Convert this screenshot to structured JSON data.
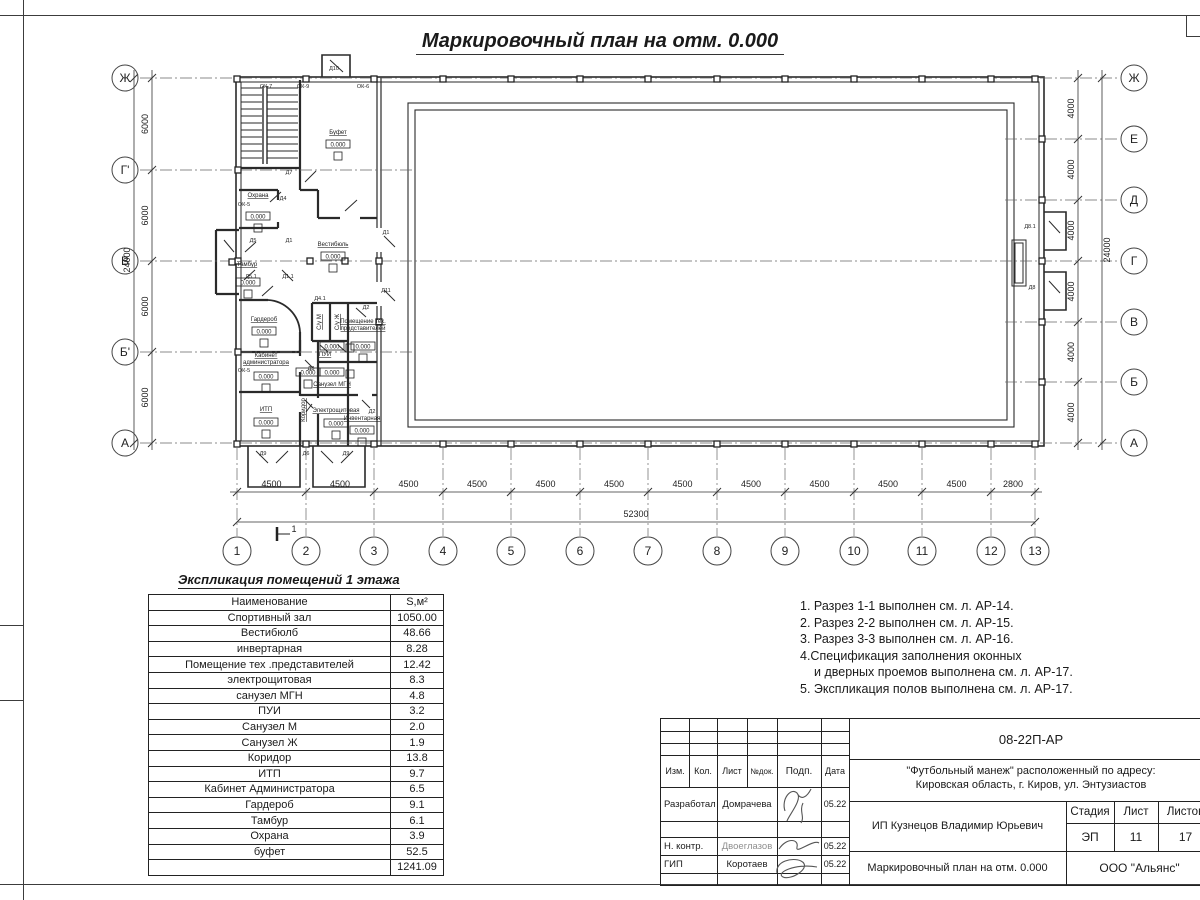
{
  "sheet": {
    "title": "Маркировочный план на отм. 0.000"
  },
  "elevation_mark": "0.000",
  "section_mark": "1",
  "axes": {
    "left": [
      "Ж",
      "Г'",
      "В",
      "Б'",
      "А"
    ],
    "right": [
      "Ж",
      "Е",
      "Д",
      "Г",
      "В",
      "Б",
      "А"
    ],
    "bottom": [
      "1",
      "2",
      "3",
      "4",
      "5",
      "6",
      "7",
      "8",
      "9",
      "10",
      "11",
      "12",
      "13"
    ]
  },
  "dimensions": {
    "left_segments": [
      "6000",
      "6000",
      "6000",
      "6000"
    ],
    "left_total": "24000",
    "right_segments": [
      "4000",
      "4000",
      "4000",
      "4000",
      "4000",
      "4000"
    ],
    "right_total": "24000",
    "bottom_segments": [
      "4500",
      "4500",
      "4500",
      "4500",
      "4500",
      "4500",
      "4500",
      "4500",
      "4500",
      "4500",
      "4500",
      "2800"
    ],
    "bottom_total": "52300"
  },
  "rooms": [
    {
      "name": "Буфет"
    },
    {
      "name": "Охрана"
    },
    {
      "name": "Тамбур"
    },
    {
      "name": "Вестибюль"
    },
    {
      "name": "Гардероб"
    },
    {
      "name": "Кабинет администратора"
    },
    {
      "name": "ИТП"
    },
    {
      "name": "Коридор"
    },
    {
      "name": "С/у М"
    },
    {
      "name": "С/у Ж"
    },
    {
      "name": "ПУИ"
    },
    {
      "name": "Санузел МГН"
    },
    {
      "name": "Помещение тех. представителей"
    },
    {
      "name": "Инвентарная"
    },
    {
      "name": "Электрощитовая"
    }
  ],
  "tags": [
    "ОК-7",
    "ОК-9",
    "Д10",
    "ОК-6",
    "ОК-5",
    "Д7",
    "Д4",
    "Д5",
    "Д1",
    "Д5.1",
    "Д1.1",
    "Д1",
    "Д11",
    "Д4.1",
    "Д2",
    "Д3",
    "ОК-5",
    "Д9",
    "Д6",
    "Д9",
    "Д2",
    "Д8.1",
    "Д8"
  ],
  "room_table": {
    "title": "Экспликация помещений 1 этажа",
    "headers": [
      "Наименование",
      "S,м²"
    ],
    "rows": [
      [
        "Спортивный зал",
        "1050.00"
      ],
      [
        "Вестибюлб",
        "48.66"
      ],
      [
        "инвертарная",
        "8.28"
      ],
      [
        "Помещение тех .представителей",
        "12.42"
      ],
      [
        "электрощитовая",
        "8.3"
      ],
      [
        "санузел МГН",
        "4.8"
      ],
      [
        "ПУИ",
        "3.2"
      ],
      [
        "Санузел М",
        "2.0"
      ],
      [
        "Санузел Ж",
        "1.9"
      ],
      [
        "Коридор",
        "13.8"
      ],
      [
        "ИТП",
        "9.7"
      ],
      [
        "Кабинет Администратора",
        "6.5"
      ],
      [
        "Гардероб",
        "9.1"
      ],
      [
        "Тамбур",
        "6.1"
      ],
      [
        "Охрана",
        "3.9"
      ],
      [
        "буфет",
        "52.5"
      ]
    ],
    "total": "1241.09"
  },
  "notes": [
    "1. Разрез 1-1 выполнен см. л. АР-14.",
    "2. Разрез 2-2 выполнен см. л. АР-15.",
    "3. Разрез 3-3 выполнен см. л. АР-16.",
    "4.Спецификация заполнения оконных",
    "и дверных проемов выполнена см. л. АР-17.",
    "5. Экспликация полов выполнена см. л. АР-17."
  ],
  "title_block": {
    "doc_number": "08-22П-АР",
    "project_line1": "\"Футбольный манеж\" расположенный по адресу:",
    "project_line2": "Кировская область, г. Киров, ул. Энтузиастов",
    "header_cells": [
      "Изм.",
      "Кол.",
      "Лист",
      "№док.",
      "Подп.",
      "Дата"
    ],
    "roles": [
      {
        "role": "Разработал",
        "name": "Домрачева",
        "date": "05.22"
      },
      {
        "role": "Н. контр.",
        "name": "Двоеглазов",
        "date": "05.22"
      },
      {
        "role": "ГИП",
        "name": "Коротаев",
        "date": "05.22"
      }
    ],
    "client": "ИП Кузнецов Владимир Юрьевич",
    "stage_headers": [
      "Стадия",
      "Лист",
      "Листов"
    ],
    "stage_values": [
      "ЭП",
      "11",
      "17"
    ],
    "sheet_title": "Маркировочный план на отм. 0.000",
    "company": "ООО \"Альянс\""
  }
}
